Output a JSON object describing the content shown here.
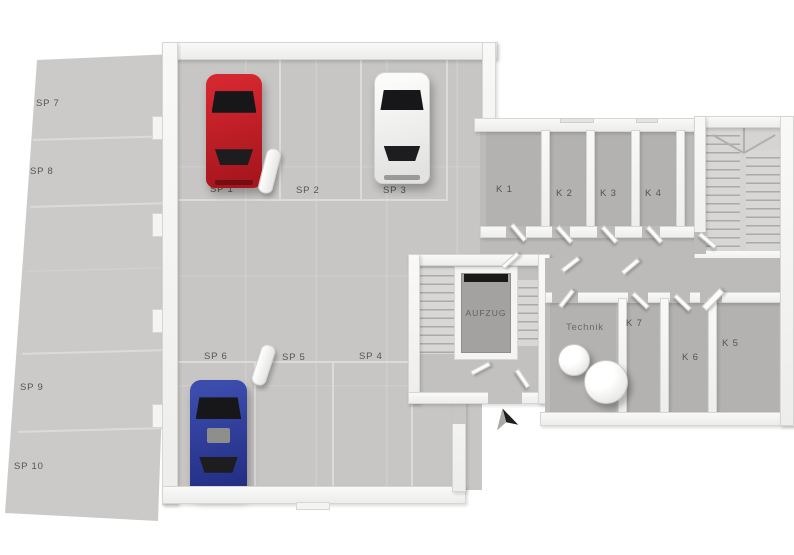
{
  "title": "3D-Grundriss Untergeschoss mit Tiefgarage",
  "outdoor": {
    "spots": [
      "SP 7",
      "SP 8",
      "SP 9",
      "SP 10"
    ]
  },
  "garage": {
    "top_row": [
      {
        "label": "SP 1",
        "car": "red"
      },
      {
        "label": "SP 2",
        "car": null
      },
      {
        "label": "SP 3",
        "car": "white"
      }
    ],
    "bottom_row": [
      {
        "label": "SP 6",
        "car": "blue"
      },
      {
        "label": "SP 5",
        "car": null
      },
      {
        "label": "SP 4",
        "car": null
      }
    ]
  },
  "cellar": {
    "top_rooms": [
      "K 1",
      "K 2",
      "K 3",
      "K 4"
    ],
    "bottom_rooms": [
      "Technik",
      "K 7",
      "K 6",
      "K 5"
    ],
    "elevator": "AUFZUG"
  },
  "cars": [
    {
      "name": "red-car",
      "color": "#c2232a",
      "spot": "SP 1"
    },
    {
      "name": "white-car",
      "color": "#f2f2f0",
      "spot": "SP 3"
    },
    {
      "name": "blue-car",
      "color": "#2d3ea1",
      "spot": "SP 6"
    }
  ],
  "icons": {
    "north_arrow": "north-arrow"
  },
  "colors": {
    "garage_floor": "#c7c6c4",
    "cellar_floor": "#bcbbb9",
    "walls": "#f7f7f5",
    "elevator_shaft": "#a3a2a0"
  }
}
